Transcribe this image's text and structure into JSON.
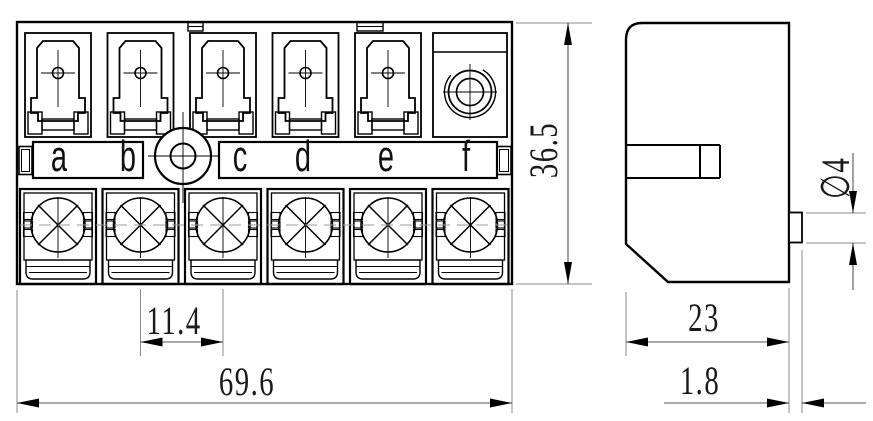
{
  "front_view": {
    "terminal_labels": [
      "a",
      "b",
      "c",
      "d",
      "e",
      "f"
    ]
  },
  "dimensions": {
    "terminal_pitch": "11.4",
    "overall_width": "69.6",
    "overall_height": "36.5",
    "side_depth": "23",
    "mounting_tab_thickness": "1.8",
    "mounting_hole_diameter": "∅4"
  },
  "colors": {
    "outline": "#000000",
    "dimension_text": "#1a1a1a",
    "extension_line": "#8a8a8a",
    "centerline": "#999999",
    "background": "#ffffff"
  }
}
